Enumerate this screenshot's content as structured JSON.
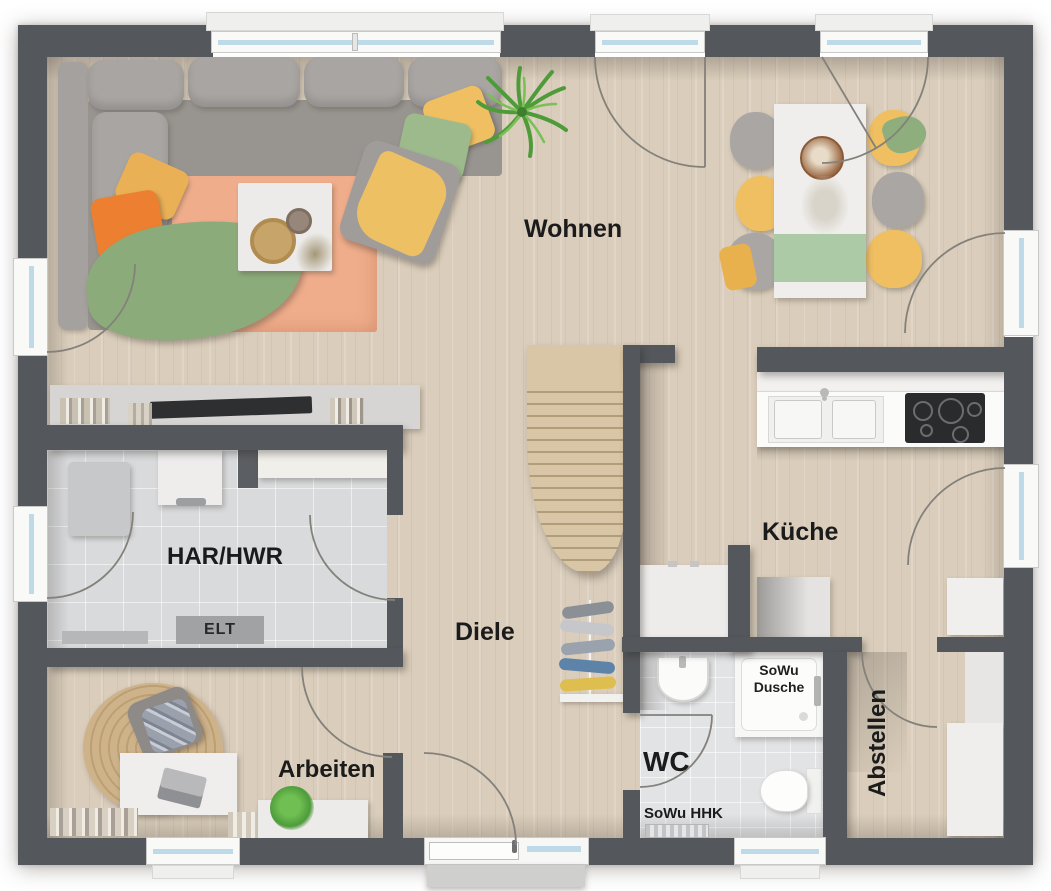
{
  "rooms": {
    "wohnen": {
      "label": "Wohnen"
    },
    "kueche": {
      "label": "Küche"
    },
    "diele": {
      "label": "Diele"
    },
    "har_hwr": {
      "label": "HAR/HWR"
    },
    "arbeiten": {
      "label": "Arbeiten"
    },
    "wc": {
      "label": "WC"
    },
    "abstellen": {
      "label": "Abstellen"
    }
  },
  "annotations": {
    "elt": "ELT",
    "sowu_dusche_line1": "SoWu",
    "sowu_dusche_line2": "Dusche",
    "sowu_hhk": "SoWu HHK"
  },
  "colors": {
    "wall": "#54575b",
    "floor_wood": "#dacdbb",
    "floor_tile": "#d9dadc",
    "rug": "#efad8b",
    "stairs_wood": "#d9c6a6",
    "accent_yellow": "#efbf62",
    "accent_orange": "#ed7f31",
    "accent_green": "#9cba8c",
    "window_glass": "#bedae9"
  }
}
